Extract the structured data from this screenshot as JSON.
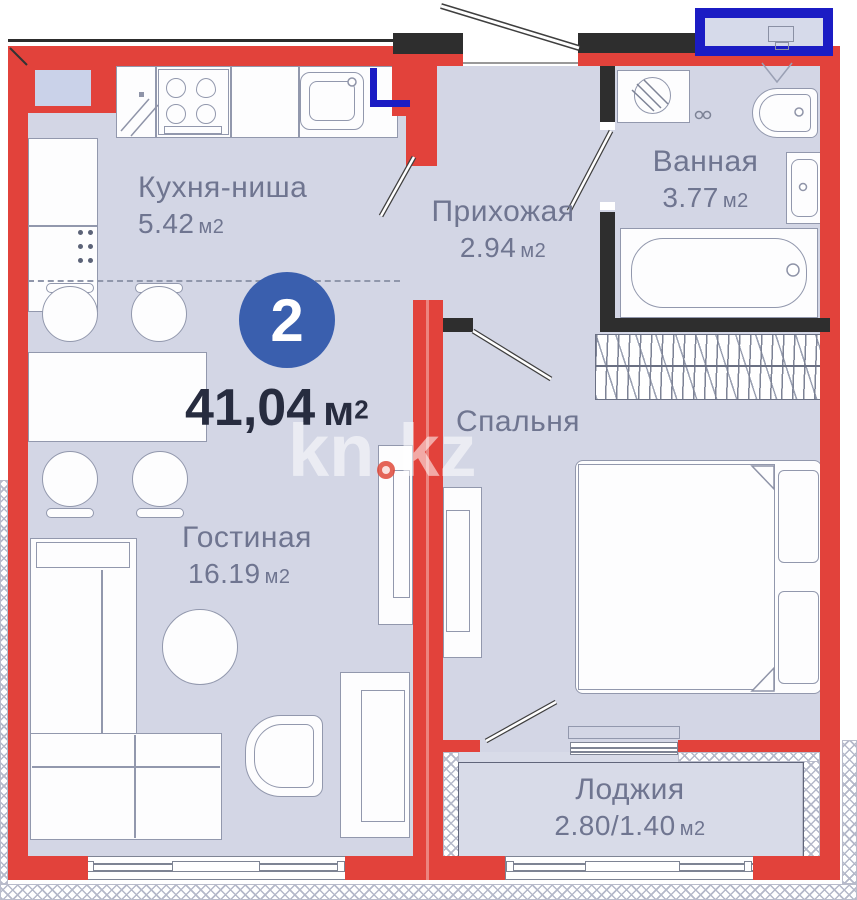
{
  "summary": {
    "room_count": "2",
    "area_value": "41,04",
    "area_unit": "м",
    "area_sup": "2"
  },
  "watermark": {
    "left": "kn",
    "right": "kz"
  },
  "rooms": {
    "kitchen": {
      "name": "Кухня-ниша",
      "area_value": "5.42",
      "area_unit": "м2"
    },
    "hallway": {
      "name": "Прихожая",
      "area_value": "2.94",
      "area_unit": "м2"
    },
    "bathroom": {
      "name": "Ванная",
      "area_value": "3.77",
      "area_unit": "м2"
    },
    "bedroom": {
      "name": "Спальня"
    },
    "living": {
      "name": "Гостиная",
      "area_value": "16.19",
      "area_unit": "м2"
    },
    "loggia": {
      "name": "Лоджия",
      "area_value": "2.80/1.40",
      "area_unit": "м2"
    }
  },
  "colors": {
    "wall_red": "#e2423b",
    "wall_black": "#2e2e2e",
    "accent_blue": "#1b1cc4",
    "floor": "#d3d6e5",
    "badge_blue": "#3a5fae",
    "label_text": "#6f7590",
    "total_text": "#272c3f"
  }
}
